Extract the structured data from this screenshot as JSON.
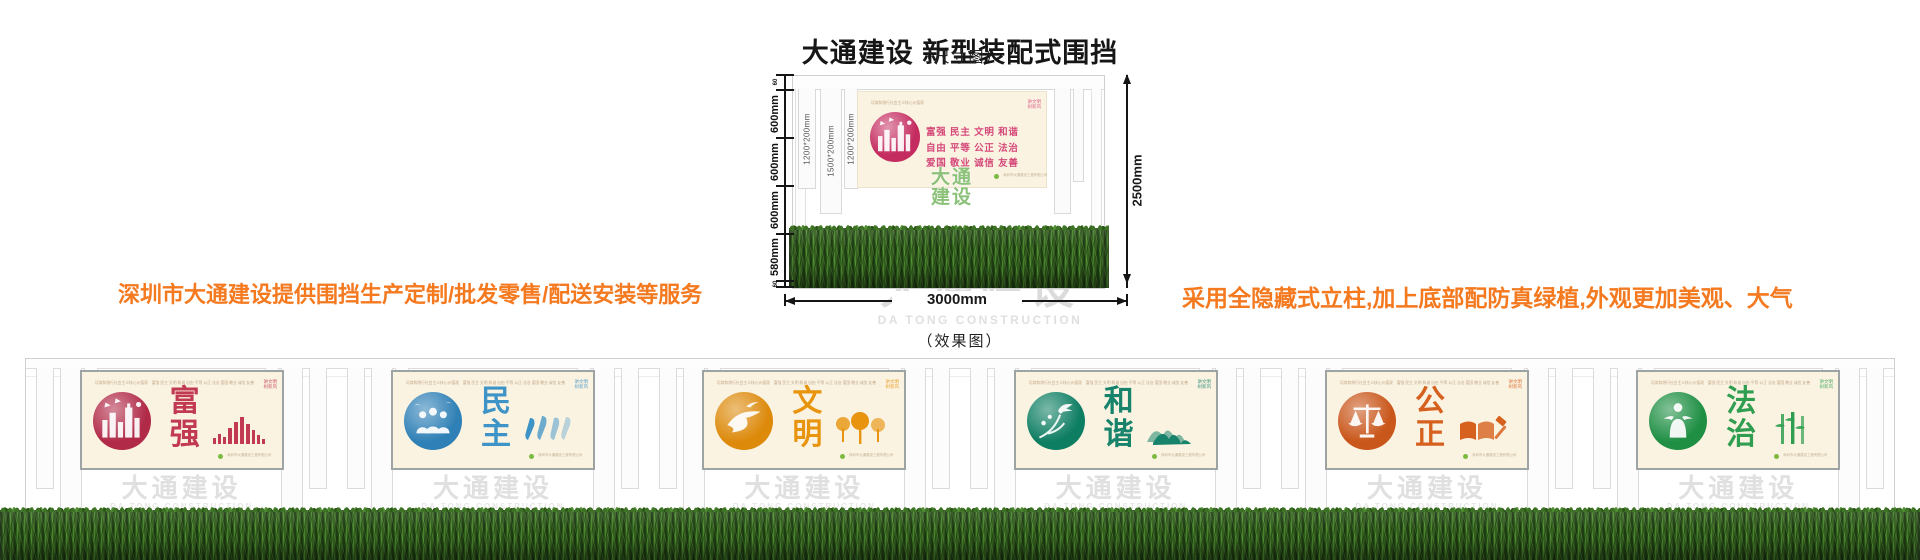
{
  "page": {
    "title": "大通建设 新型装配式围挡",
    "dim_figure_label": "（尺寸图）",
    "effect_figure_label": "（效果图）"
  },
  "notes": {
    "left": "深圳市大通建设提供围挡生产定制/批发零售/配送安装等服务",
    "right": "采用全隐藏式立柱,加上底部配防真绿植,外观更加美观、大气",
    "color": "#F4791F"
  },
  "watermark": {
    "cn": "大通建设",
    "en": "DA TONG CONSTRUCTION",
    "green_lines": [
      "大通",
      "建设"
    ]
  },
  "dimension_diagram": {
    "total_height_label": "2500mm",
    "total_width_label": "3000mm",
    "height_segment_labels": [
      "60",
      "600mm",
      "600mm",
      "600mm",
      "580mm",
      "60"
    ],
    "post_labels": [
      "1200*200mm",
      "1500*200mm",
      "1200*200mm"
    ],
    "board": {
      "value_rows": [
        "富强 民主 文明 和谐",
        "自由 平等 公正 法治",
        "爱国 敬业 诚信 友善"
      ],
      "accent": "#D5487A",
      "circle_color": "#C42B5E"
    }
  },
  "board_common": {
    "micro_header": "培育和践行社会主义核心价值观",
    "values_inline": "富强 民主 文明 和谐 自由 平等 公正 法治 爱国 敬业 诚信 友善",
    "corner_lines": [
      "讲文明",
      "树新风"
    ],
    "footer_micro": "深圳市大通建设工程有限公司"
  },
  "effect_panels": [
    {
      "title": "富强",
      "accent": "#C23A52",
      "circle_color": "#B12A48",
      "circle_motif": "city",
      "side_motif": "bars"
    },
    {
      "title": "民主",
      "accent": "#3E93C7",
      "circle_color": "#2F80B6",
      "circle_motif": "people",
      "side_motif": "figures"
    },
    {
      "title": "文明",
      "accent": "#E8940F",
      "circle_color": "#DD8A0B",
      "circle_motif": "dove",
      "side_motif": "trees"
    },
    {
      "title": "和谐",
      "accent": "#17836B",
      "circle_color": "#0E7E63",
      "circle_motif": "crane",
      "side_motif": "mountains"
    },
    {
      "title": "公正",
      "accent": "#D6611F",
      "circle_color": "#C9561A",
      "circle_motif": "scales",
      "side_motif": "book"
    },
    {
      "title": "法治",
      "accent": "#2F9E50",
      "circle_color": "#1F8F44",
      "circle_motif": "justice",
      "side_motif": "bamboo"
    }
  ]
}
